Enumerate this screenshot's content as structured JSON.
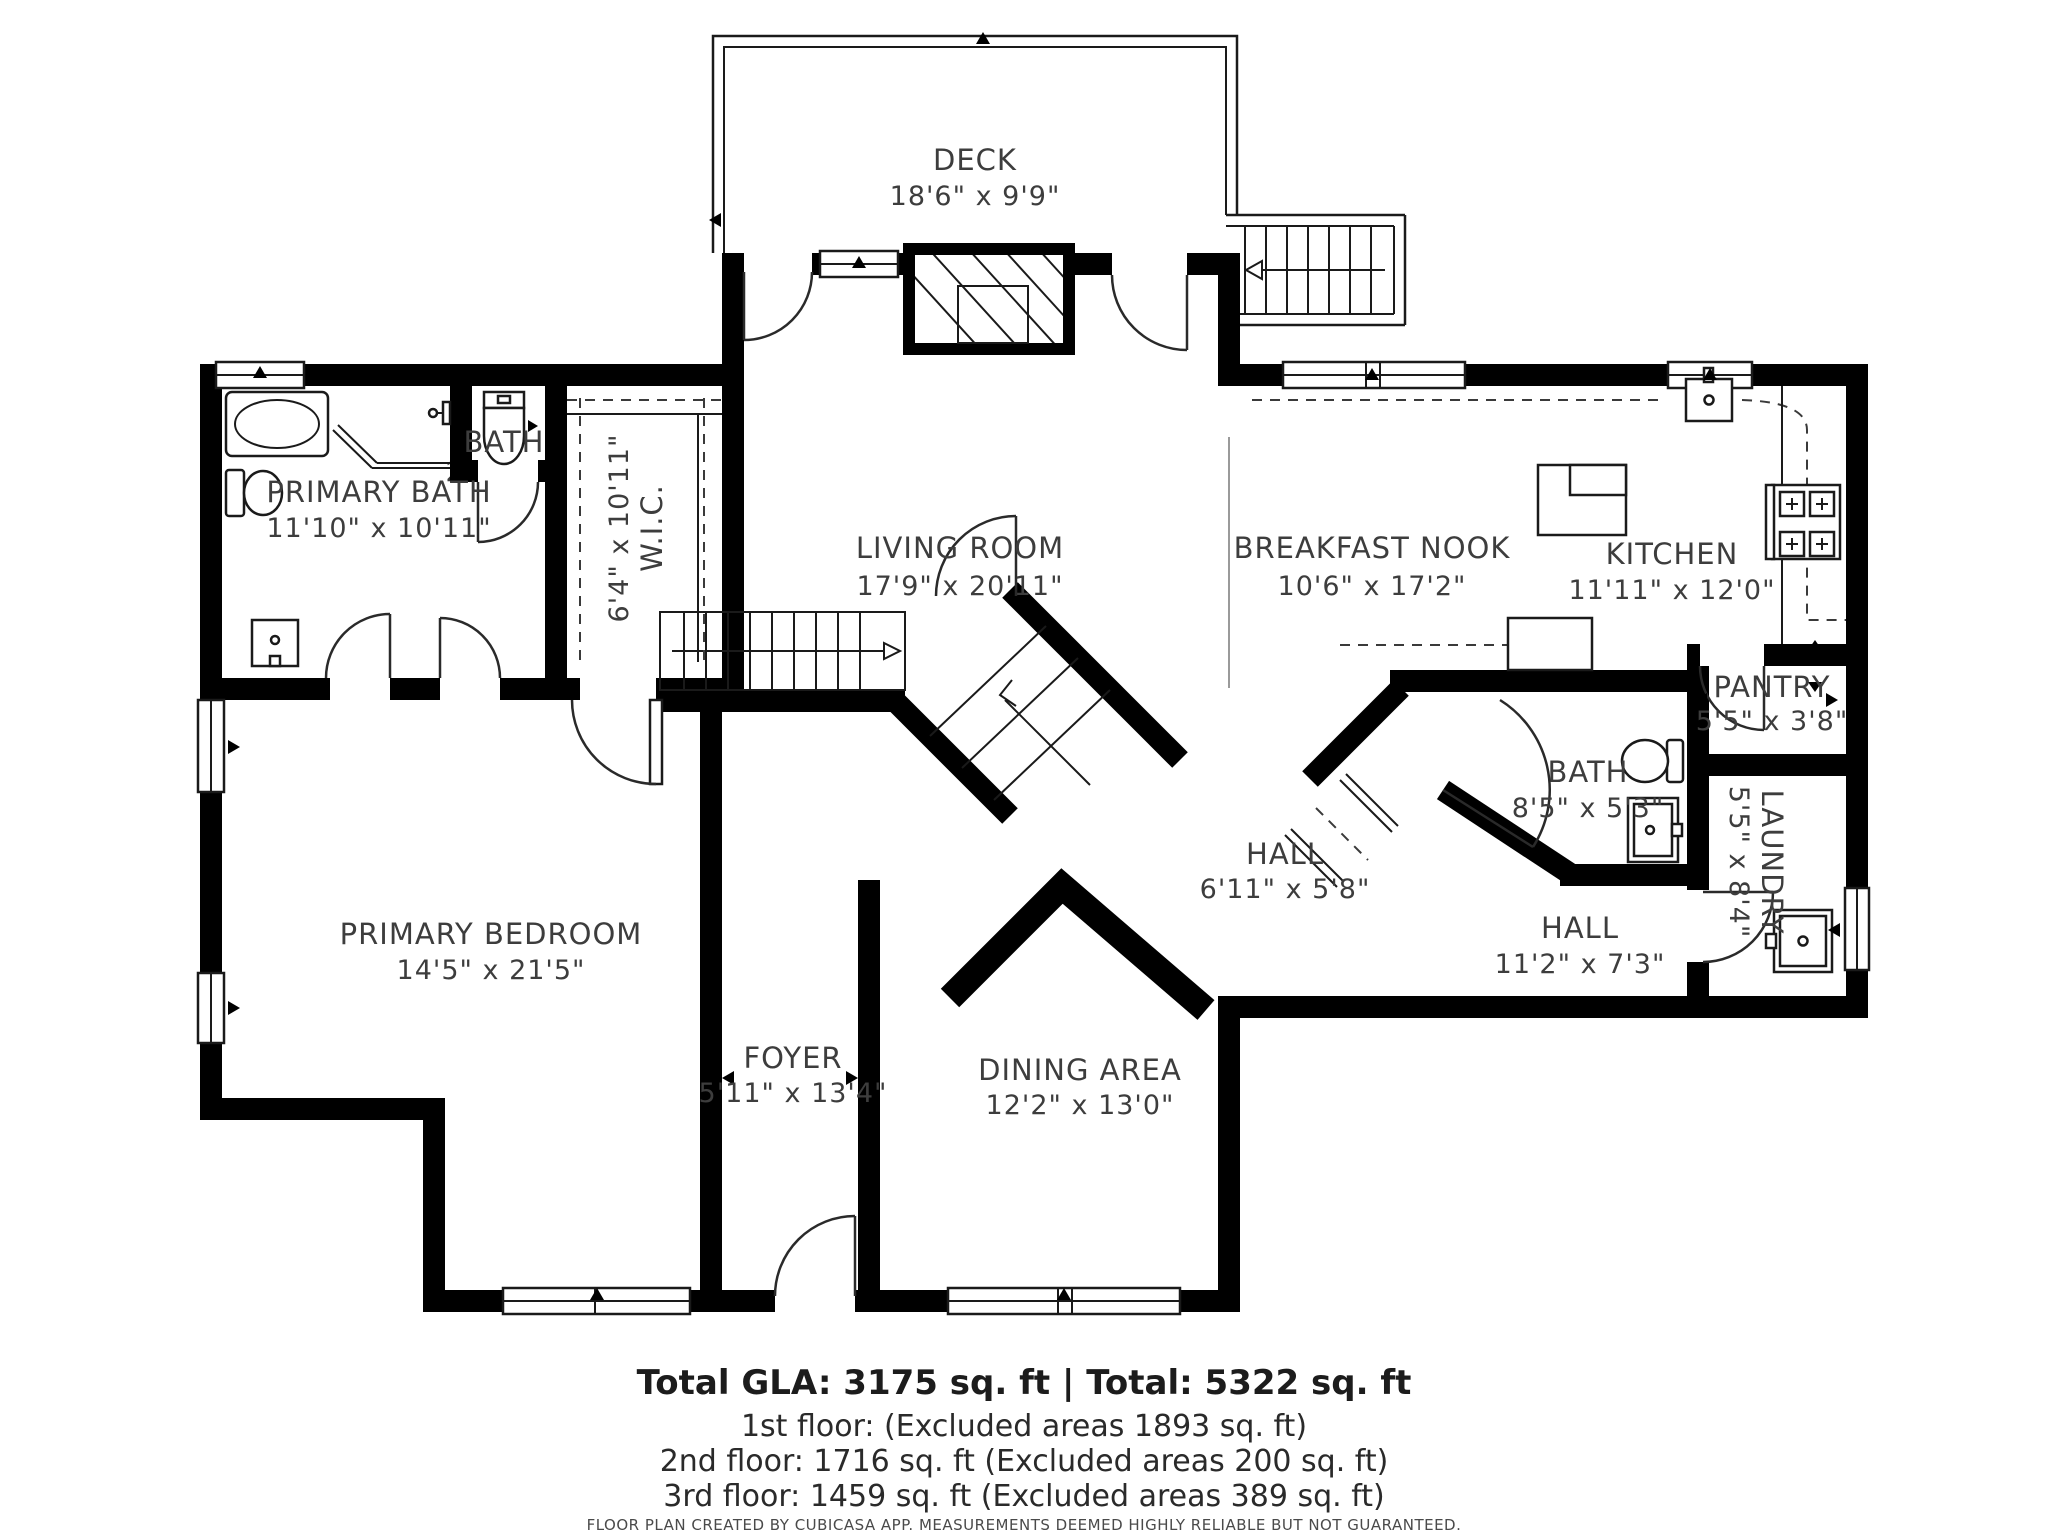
{
  "plan": {
    "rooms": {
      "deck": {
        "name": "DECK",
        "dims": "18'6\" x 9'9\""
      },
      "primary_bath": {
        "name": "PRIMARY BATH",
        "dims": "11'10\" x 10'11\""
      },
      "toilet_room": {
        "name": "BATH",
        "dims": "2'6\" x 3'"
      },
      "wic": {
        "name": "W.I.C.",
        "dims": "6'4\" x 10'11\""
      },
      "living_room": {
        "name": "LIVING ROOM",
        "dims": "17'9\" x 20'11\""
      },
      "breakfast_nook": {
        "name": "BREAKFAST NOOK",
        "dims": "10'6\" x 17'2\""
      },
      "kitchen": {
        "name": "KITCHEN",
        "dims": "11'11\" x 12'0\""
      },
      "pantry": {
        "name": "PANTRY",
        "dims": "5'5\" x 3'8\""
      },
      "bath": {
        "name": "BATH",
        "dims": "8'5\" x 5'3\""
      },
      "laundry": {
        "name": "LAUNDRY",
        "dims": "5'5\" x 8'4\""
      },
      "hall_upper": {
        "name": "HALL",
        "d ims_unused": "",
        "dims": "6'11\" x 5'8\""
      },
      "hall_lower": {
        "name": "HALL",
        "dims": "11'2\" x 7'3\""
      },
      "primary_bedroom": {
        "name": "PRIMARY BEDROOM",
        "dims": "14'5\" x 21'5\""
      },
      "foyer": {
        "name": "FOYER",
        "dims": "5'11\" x 13'4\""
      },
      "dining_area": {
        "name": "DINING AREA",
        "dims": "12'2\" x 13'0\""
      }
    },
    "summary": {
      "total": "Total GLA: 3175 sq. ft | Total: 5322 sq. ft",
      "floor1": "1st floor: (Excluded areas 1893 sq. ft)",
      "floor2": "2nd floor: 1716 sq. ft (Excluded areas 200 sq. ft)",
      "floor3": "3rd floor: 1459 sq. ft (Excluded areas 389 sq. ft)",
      "disclaimer": "FLOOR PLAN CREATED BY CUBICASA APP. MEASUREMENTS DEEMED HIGHLY RELIABLE BUT NOT GUARANTEED."
    },
    "colors": {
      "wall": "#000000",
      "text": "#3d3d3d",
      "background": "#ffffff"
    }
  }
}
